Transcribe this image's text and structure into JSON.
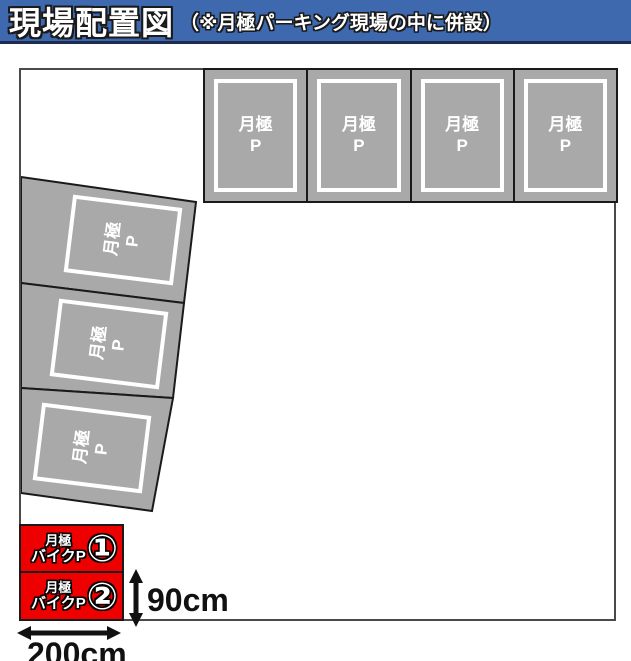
{
  "header": {
    "title": "現場配置図",
    "note": "（※月極パーキング現場の中に併設）"
  },
  "colors": {
    "header_bg": "#3e69ae",
    "header_rule": "#1d2b4e",
    "space_fill": "#a9a9a9",
    "space_border": "#1a1a1a",
    "space_inner_border": "#ffffff",
    "bike_fill": "#ee0000",
    "site_border": "#4a4a4a",
    "space_text": "#ffffff",
    "dimension_text": "#111111"
  },
  "spaces": {
    "top": [
      {
        "name": "月極",
        "mark": "P"
      },
      {
        "name": "月極",
        "mark": "P"
      },
      {
        "name": "月極",
        "mark": "P"
      },
      {
        "name": "月極",
        "mark": "P"
      }
    ],
    "left": [
      {
        "name": "月極",
        "mark": "P"
      },
      {
        "name": "月極",
        "mark": "P"
      },
      {
        "name": "月極",
        "mark": "P"
      }
    ]
  },
  "bike": [
    {
      "line1": "月極",
      "line2": "バイクP",
      "number": "①"
    },
    {
      "line1": "月極",
      "line2": "バイクP",
      "number": "②"
    }
  ],
  "dimensions": {
    "height": "90cm",
    "width": "200cm"
  }
}
